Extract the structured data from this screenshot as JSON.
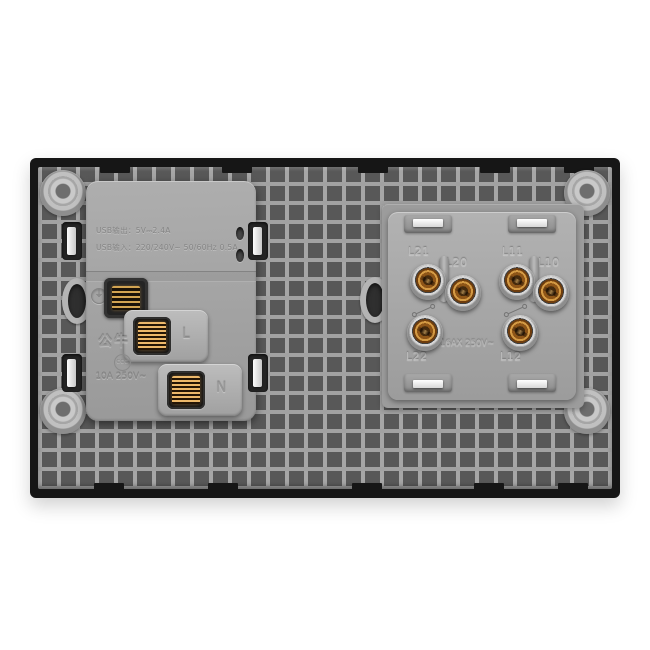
{
  "usb_module": {
    "spec_line_1": "USB输出：5V⎓2.4A",
    "spec_line_2": "USB输入：220/240V~ 50/60Hz 0.5A",
    "earth_symbol": "⏚",
    "live_terminal_label": "L",
    "neutral_terminal_label": "N",
    "brand": "公牛",
    "cert_mark": "CCC",
    "rating": "10A 250V~"
  },
  "switch_module": {
    "terminal_labels": {
      "top_left_outer": "L21",
      "top_left_inner": "L20",
      "top_right_outer": "L11",
      "top_right_inner": "L10",
      "bottom_left": "L22",
      "bottom_right": "L12"
    },
    "rating": "16AX 250V~"
  },
  "colors": {
    "plate_frame": "#161616",
    "plate_body": "#9a9a9a",
    "module_gray": "#a8a8a8",
    "terminal_brass": "#c08a3e",
    "clip_white": "#f4f4f4",
    "background": "#ffffff"
  }
}
